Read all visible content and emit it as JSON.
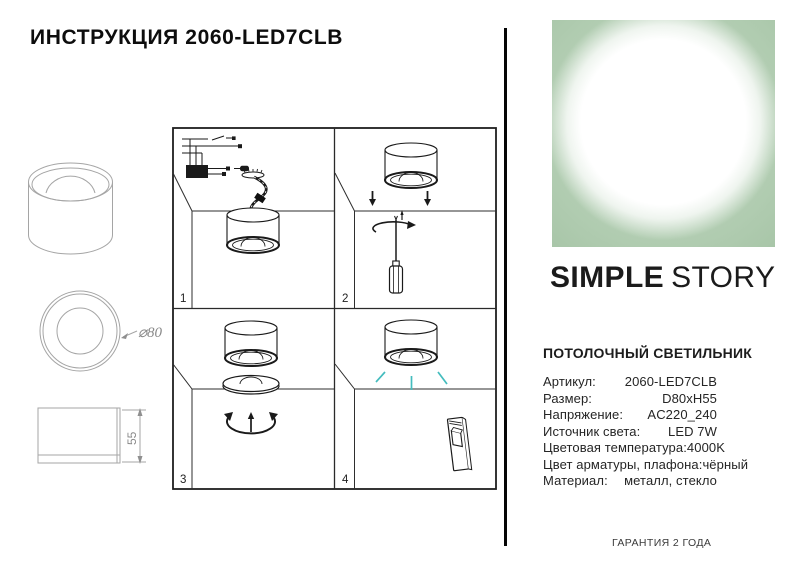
{
  "page": {
    "title": "ИНСТРУКЦИЯ 2060-LED7CLB"
  },
  "brand": {
    "name_bold": "SIMPLE",
    "name_light": "STORY"
  },
  "dimensions": {
    "diameter_label": "⌀80",
    "height_label": "55"
  },
  "instructions": {
    "steps": [
      {
        "number": "1",
        "description": "connect-wires-hang-lamp"
      },
      {
        "number": "2",
        "description": "fix-base-with-screwdriver"
      },
      {
        "number": "3",
        "description": "screw-on-diffuser-ring"
      },
      {
        "number": "4",
        "description": "switch-on-light"
      }
    ]
  },
  "product": {
    "heading": "ПОТОЛОЧНЫЙ СВЕТИЛЬНИК",
    "specs": [
      {
        "label": "Артикул:",
        "value": "2060-LED7CLB"
      },
      {
        "label": "Размер:",
        "value": "D80xH55"
      },
      {
        "label": "Напряжение:",
        "value": "AC220_240"
      },
      {
        "label": "Источник света:",
        "value": "LED 7W"
      },
      {
        "label": "Цветовая температура:",
        "value": "4000K"
      },
      {
        "label": "Цвет арматуры, плафона:",
        "value": "чёрный"
      },
      {
        "label": "Материал:",
        "value": "металл, стекло"
      }
    ]
  },
  "footer": {
    "warranty": "ГАРАНТИЯ 2 ГОДА"
  },
  "colors": {
    "accent_green": "#a6c4a6",
    "light_ray_teal": "#44bcbe",
    "drawing_gray": "#a5a5a5",
    "ink": "#1a1a1a"
  }
}
